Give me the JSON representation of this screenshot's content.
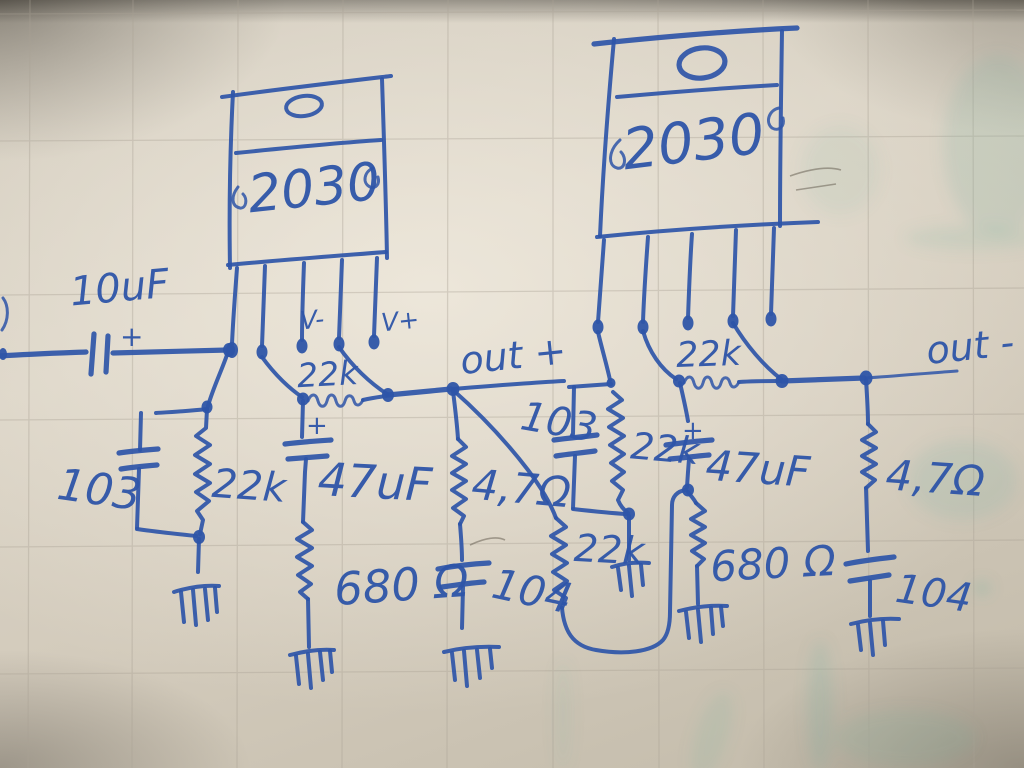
{
  "meta": {
    "description": "Hand-drawn whiteboard schematic of a two-chip 2030 bridged audio amplifier, blue marker on gridded board",
    "ink_color": "#2e55a8",
    "board_color": "#d6cfc1",
    "grid_color": "#aaa295",
    "smudge_color": "#6fae9e"
  },
  "ic_left": {
    "part": "2030"
  },
  "ic_right": {
    "part": "2030"
  },
  "labels": {
    "input_cap_value": "10uF",
    "input_cap_polarity": "+",
    "left_input_cap": "103",
    "left_input_res": "22k",
    "vminus": "V-",
    "vplus": "V+",
    "left_feedback_res": "22k",
    "left_fb_cap_polarity": "+",
    "left_fb_cap": "47uF",
    "left_fb_res": "680 Ω",
    "out_plus": "out +",
    "left_zobel_res": "4,7Ω",
    "left_zobel_cap": "104",
    "mid_input_cap": "103",
    "mid_input_res": "22k",
    "bridge_res": "22k",
    "right_feedback_res": "22k",
    "right_fb_cap_polarity": "+",
    "right_fb_cap": "47uF",
    "right_fb_res": "680 Ω",
    "out_minus": "out -",
    "right_zobel_res": "4,7Ω",
    "right_zobel_cap": "104"
  }
}
